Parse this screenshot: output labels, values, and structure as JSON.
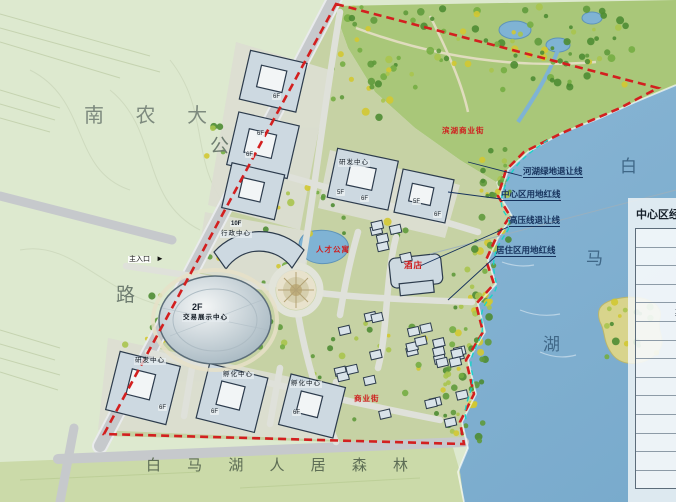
{
  "map": {
    "regions": {
      "university": "南 农 大",
      "road_char_top": "公",
      "road_char_bottom": "路",
      "forest_strip": "白 马 湖 人 居 森 林",
      "lake_name_chars": [
        "白",
        "马",
        "湖"
      ]
    },
    "setback_labels": [
      "河湖绿地退让线",
      "中心区用地红线",
      "高压线退让线",
      "居住区用地红线"
    ],
    "entrance": {
      "label": "主入口",
      "arrow": "►"
    },
    "buildings": {
      "admin_center": {
        "floors": "10F",
        "name": "行政中心"
      },
      "expo_center": {
        "floors": "2F",
        "name": "交易展示中心"
      },
      "rnd_center_mid": {
        "name": "研发中心",
        "floor_a": "5F",
        "floor_b": "6F"
      },
      "office_east": {
        "floor_a": "5F",
        "floor_b": "6F"
      },
      "nw_floor_tags": [
        "6F",
        "6F",
        "6F"
      ],
      "rnd_center_south": {
        "name": "研发中心",
        "floor": "6F"
      },
      "incubator_south1": {
        "name": "孵化中心",
        "floor": "6F"
      },
      "incubator_south2": {
        "name": "孵化中心",
        "floor": "6F"
      }
    },
    "red_labels": {
      "waterfront_street": "滨湖商业街",
      "apartments": "人才公寓",
      "hotel": "酒店",
      "commercial_street": "商业街"
    }
  },
  "panel": {
    "title": "中心区经济技术指标",
    "rows": [
      "名称",
      "规划总用地",
      "总建筑面积",
      "地上建筑面积",
      "其中：行政中心",
      "交易展示中心",
      "研发中心",
      "酒店",
      "孵化中心",
      "建筑占地面积",
      "容积率",
      "建筑密度",
      "绿地率",
      "机动车位"
    ]
  },
  "colors": {
    "lake": "#82b0d2",
    "field": "#dde9cf",
    "forest": "#cbdaa9",
    "boundary_red": "#d31f1f",
    "setback_cyan": "#14d6c8"
  }
}
